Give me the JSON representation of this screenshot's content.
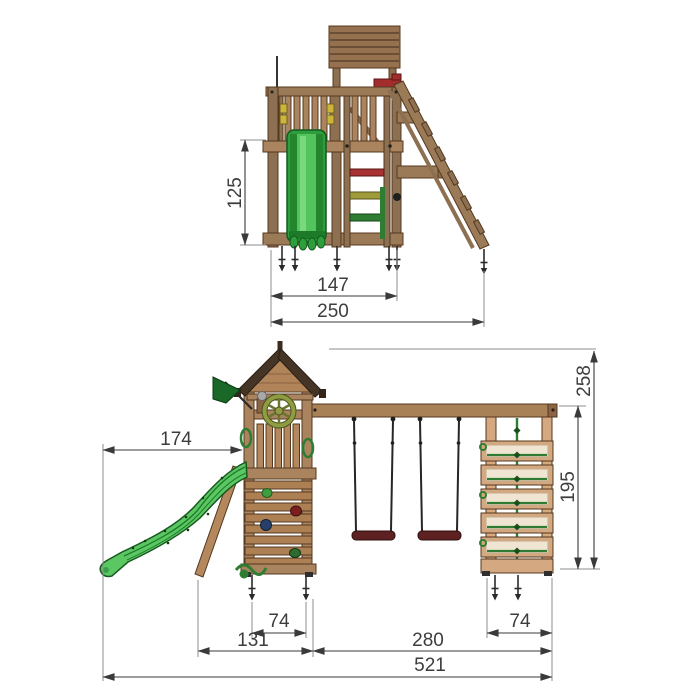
{
  "colors": {
    "background": "#ffffff",
    "wood_mid": "#9b7a58",
    "wood_light": "#d4a880",
    "wood_plank": "#ad8054",
    "wood_dark_outline": "#54381f",
    "roof_shingle": "#453526",
    "slide_green": "#5bc763",
    "slide_green_dark": "#1d7a29",
    "flag_green": "#196828",
    "wheel_olive": "#8f9c42",
    "swing_seat_maroon": "#5d2121",
    "rung_red": "#a63232",
    "rung_olive": "#9f9b3a",
    "rung_green": "#2f7d33",
    "net_green": "#2e7d32",
    "dim_line": "#3a3a3a"
  },
  "side_view": {
    "dims": {
      "platform_height": "125",
      "frame_depth": "147",
      "total_depth": "250"
    }
  },
  "front_view": {
    "dims": {
      "slide_reach": "174",
      "total_height": "258",
      "frame_height": "195",
      "tower_base_width": "74",
      "slide_section_width": "131",
      "swing_section_width": "280",
      "frame_base_width": "74",
      "total_width": "521"
    }
  }
}
